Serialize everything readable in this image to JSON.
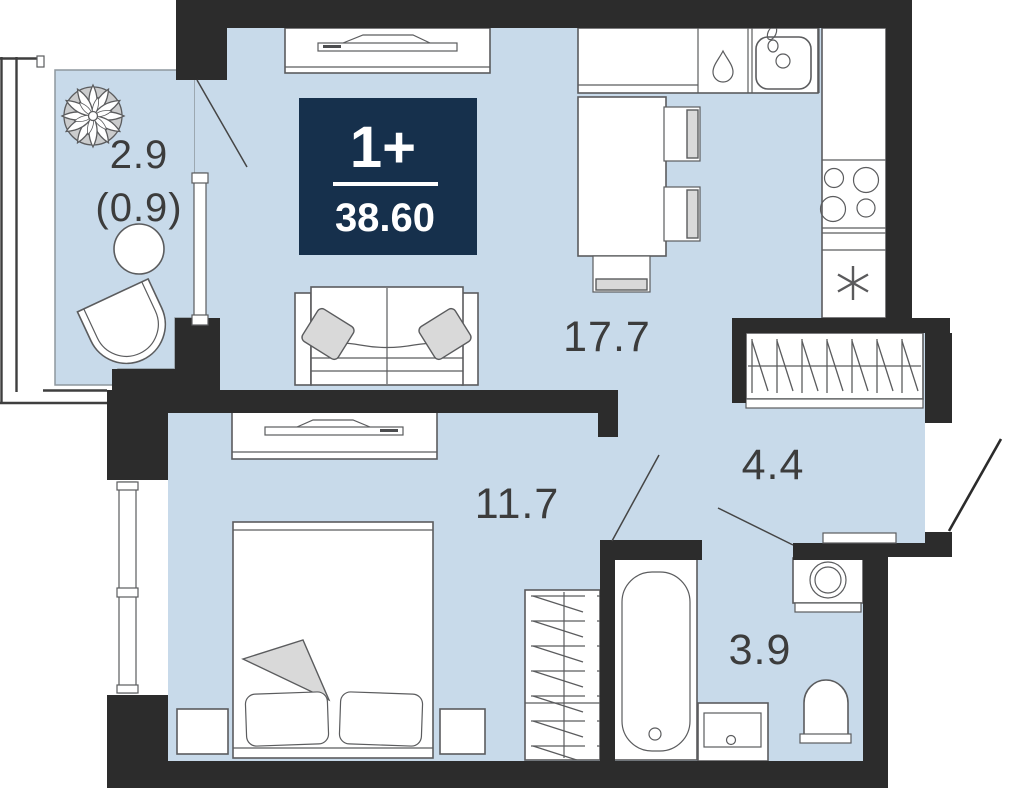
{
  "title": "Apartment floor plan",
  "badge": {
    "type": "1+",
    "area": "38.60"
  },
  "areas": {
    "balcony": "2.9",
    "balcony_reduced": "(0.9)",
    "living_kitchen": "17.7",
    "bedroom": "11.7",
    "hallway": "4.4",
    "bathroom": "3.9"
  },
  "colors": {
    "room_fill": "#c8daea",
    "wall": "#2c2c2c",
    "badge_bg": "#16304c",
    "badge_text": "#ffffff",
    "furniture_stroke": "#5b5c5e",
    "label_text": "#3c3c3c",
    "soft_gray": "#d9d9d9"
  },
  "icon_names": [
    "plant-icon",
    "round-table-icon",
    "armchair-icon",
    "tv-console-icon",
    "sofa-icon",
    "kitchen-counter-icon",
    "water-drop-icon",
    "kitchen-sink-icon",
    "fridge-icon",
    "stove-icon",
    "freezer-asterisk-icon",
    "dining-table-icon",
    "chair-icon",
    "bench-icon",
    "hall-closet-icon",
    "wardrobe-icon",
    "bed-icon",
    "nightstand-icon",
    "bathtub-icon",
    "vanity-sink-icon",
    "toilet-icon",
    "washing-machine-icon",
    "window-icon",
    "door-swing-icon",
    "entrance-door-swing-icon"
  ]
}
